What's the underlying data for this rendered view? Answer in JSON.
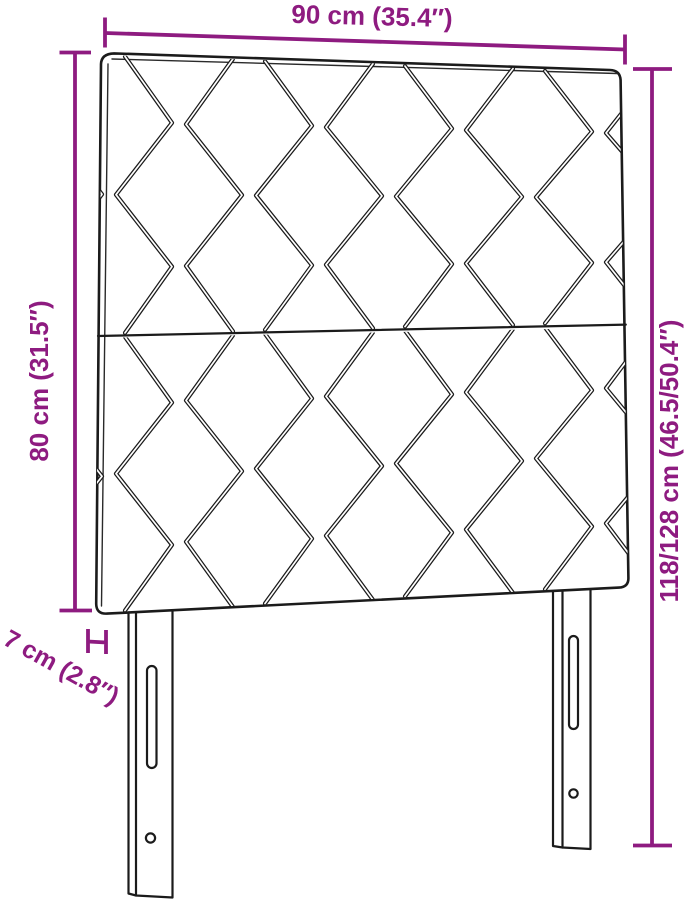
{
  "diagram": {
    "type": "product-dimension-diagram",
    "dimension_labels": {
      "width": "90 cm (35.4″)",
      "upholstered_height": "80 cm (31.5″)",
      "total_height": "118/128 cm (46.5/50.4″)",
      "depth": "7 cm (2.8″)"
    },
    "colors": {
      "dimension": "#8e1b80",
      "outline": "#1b1b1b",
      "background": "#ffffff"
    }
  }
}
